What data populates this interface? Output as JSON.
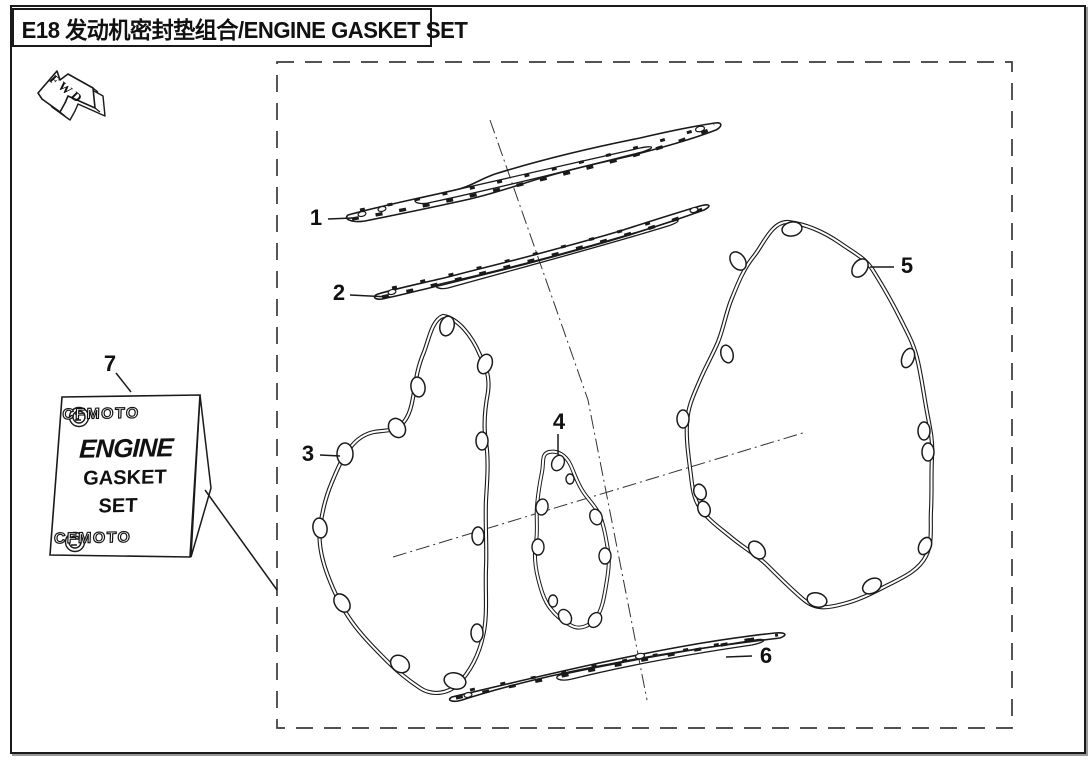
{
  "page": {
    "title": "E18 发动机密封垫组合/ENGINE GASKET SET",
    "fwd_marker": "FWD",
    "background_color": "#ffffff",
    "line_color": "#1a1a1a"
  },
  "label_box": {
    "brand_top": "CFMOTO",
    "product_line1": "ENGINE",
    "product_line2": "GASKET",
    "product_line3": "SET",
    "brand_bottom": "CFMOTO"
  },
  "callouts": [
    {
      "label": "1"
    },
    {
      "label": "2"
    },
    {
      "label": "3"
    },
    {
      "label": "4"
    },
    {
      "label": "5"
    },
    {
      "label": "6"
    },
    {
      "label": "7"
    }
  ]
}
